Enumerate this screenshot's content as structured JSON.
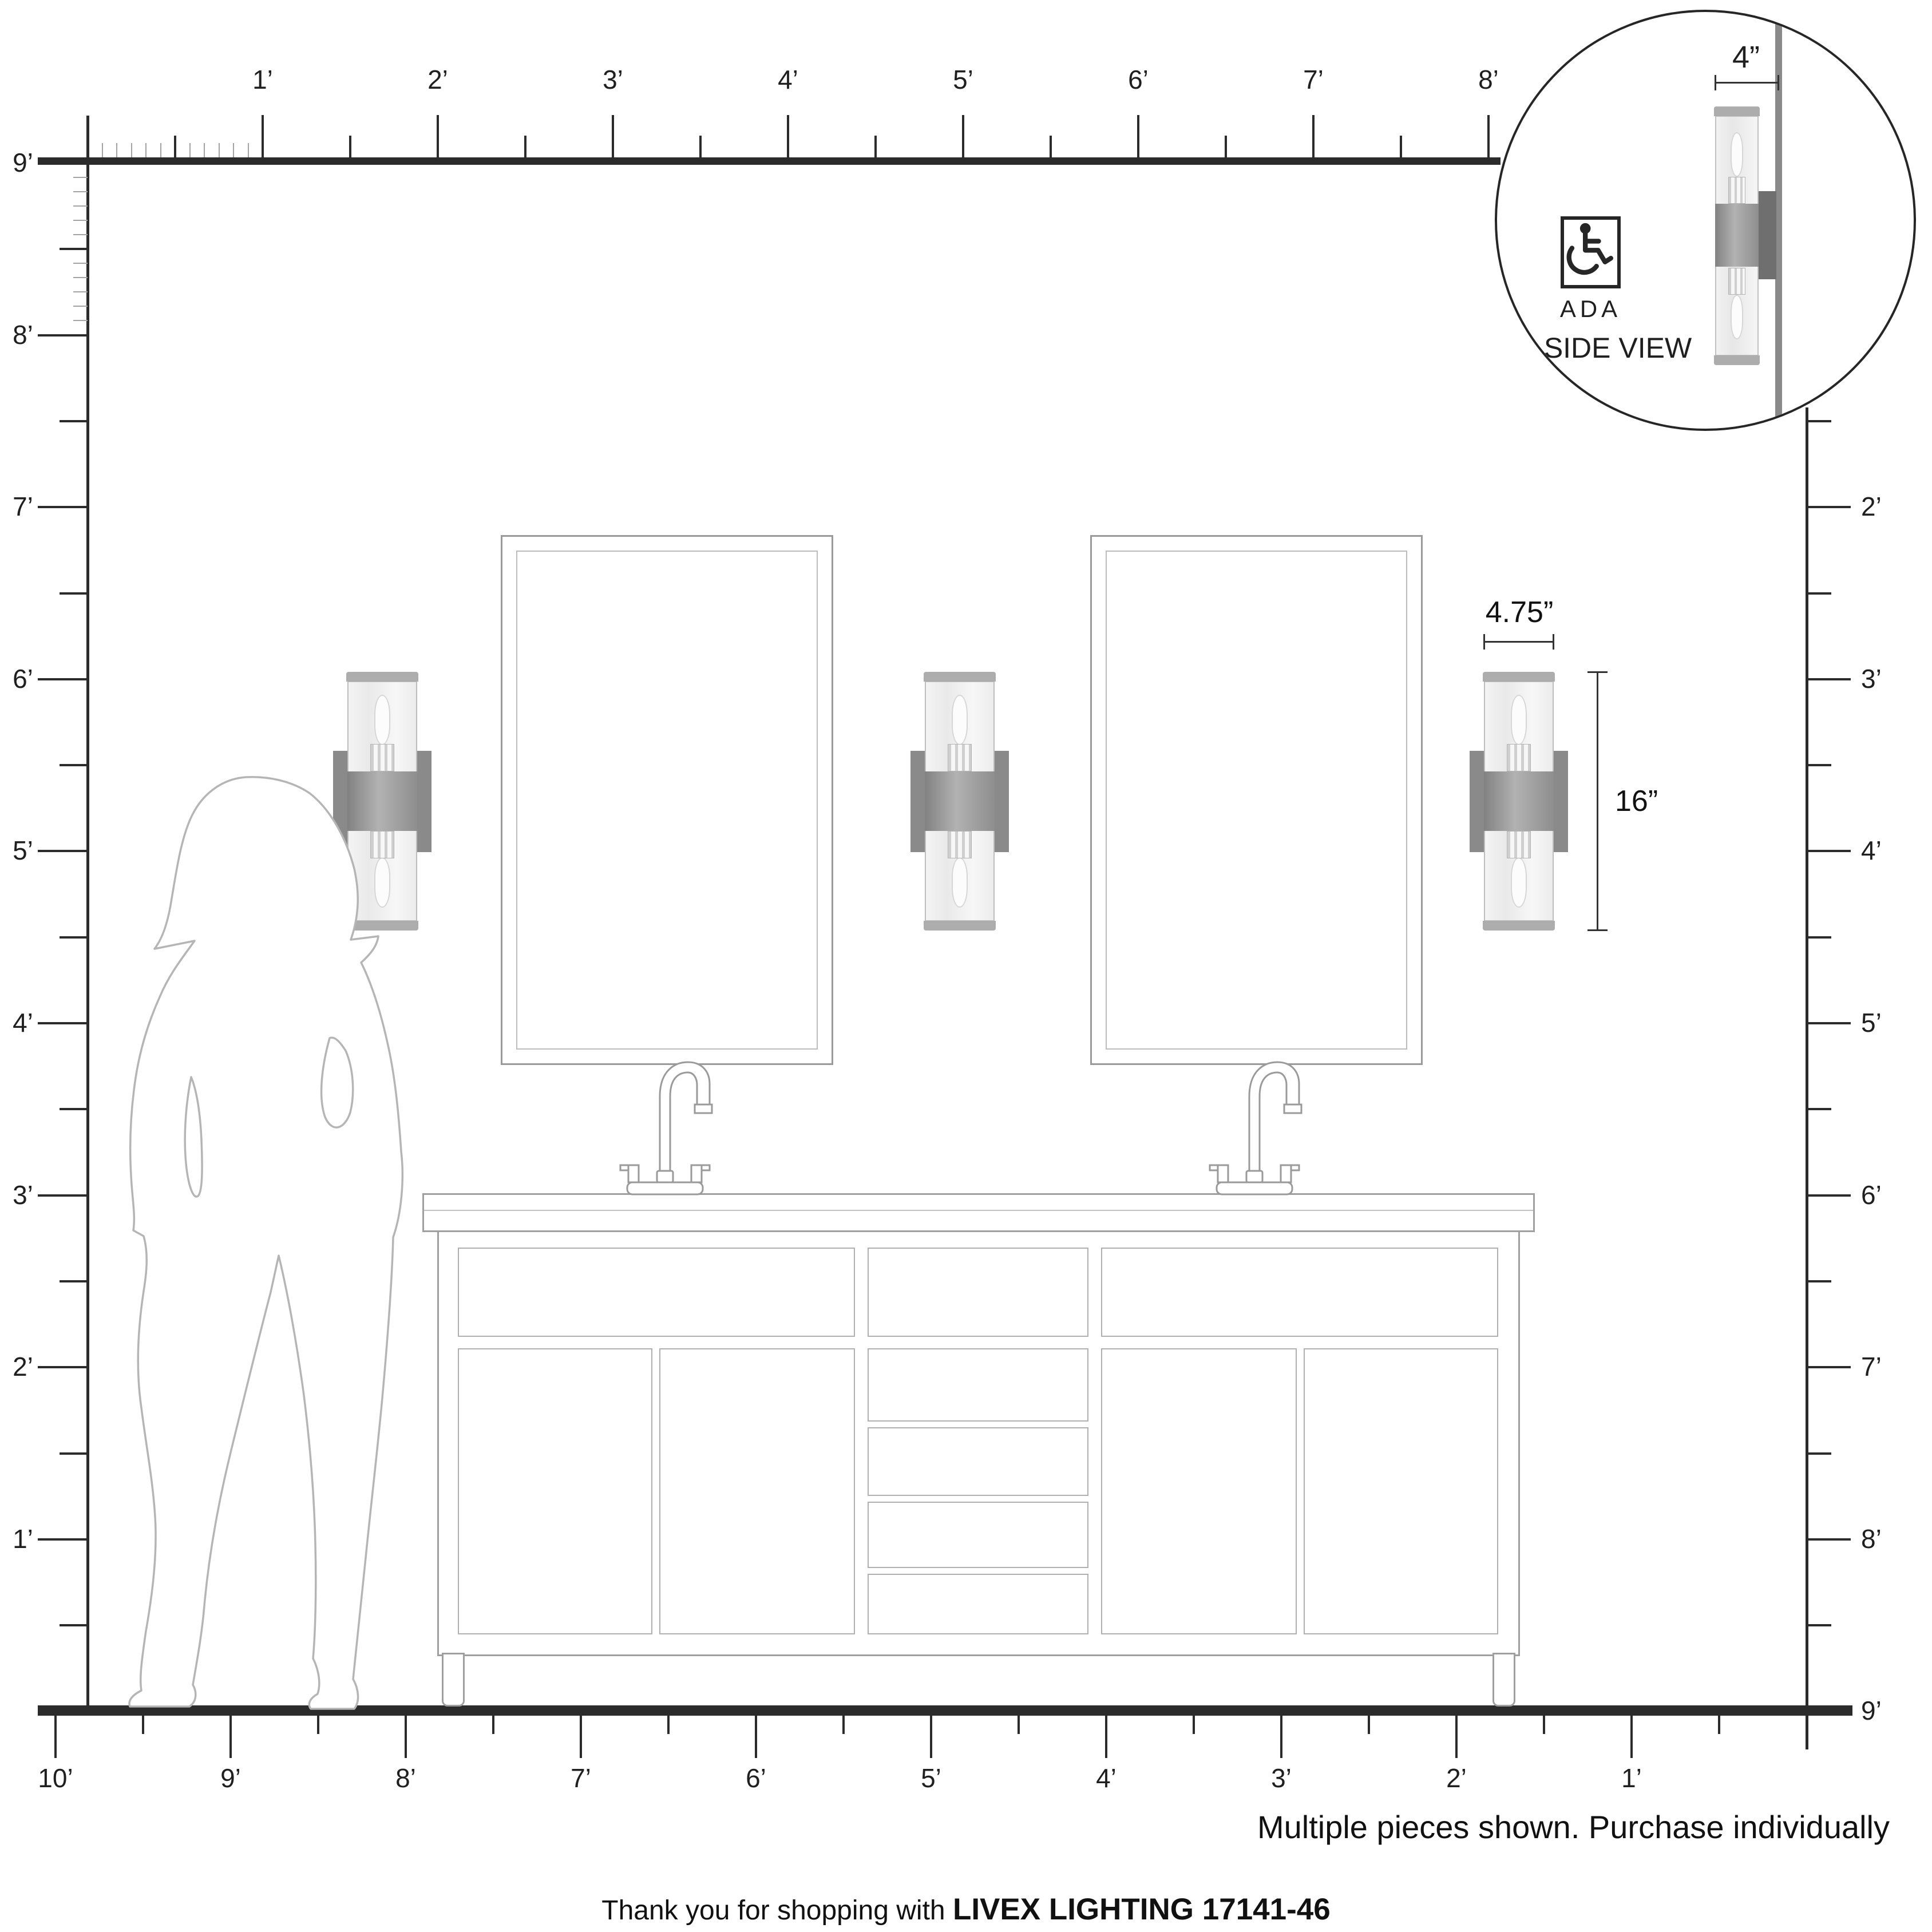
{
  "rulers": {
    "top": [
      "1’",
      "2’",
      "3’",
      "4’",
      "5’",
      "6’",
      "7’",
      "8’"
    ],
    "left": [
      "9’",
      "8’",
      "7’",
      "6’",
      "5’",
      "4’",
      "3’",
      "2’",
      "1’"
    ],
    "right": [
      "2’",
      "3’",
      "4’",
      "5’",
      "6’",
      "7’",
      "8’",
      "9’"
    ],
    "bottom": [
      "10’",
      "9’",
      "8’",
      "7’",
      "6’",
      "5’",
      "4’",
      "3’",
      "2’",
      "1’"
    ]
  },
  "dimensions": {
    "width_label": "4.75”",
    "height_label": "16”",
    "depth_label": "4”"
  },
  "inset": {
    "ada_label": "ADA",
    "side_view_label": "SIDE VIEW"
  },
  "footer": {
    "note": "Multiple pieces shown. Purchase individually",
    "thanks_prefix": "Thank you for shopping with",
    "brand": "LIVEX LIGHTING 17141-46"
  }
}
